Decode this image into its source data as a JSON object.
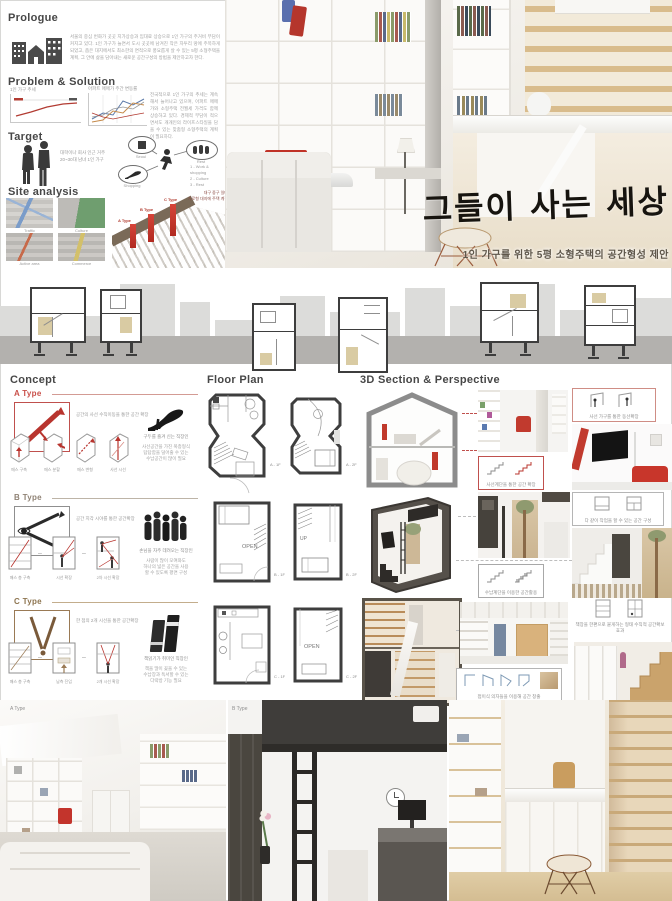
{
  "poster": {
    "prologue": {
      "title": "Prologue",
      "body": "서울의 중심 번화가 곳곳 지가상승과 임대료 상승으로 1인 가구의 주거비 부담이 커지고 있다. 1인 가구가 늘면서 도시 곳곳에 남겨진 작은 자투리 땅에 주목하게 되었고, 좁은 대지에서도 최소한의 면적으로 풍요롭게 살 수 있는 5평 소형주택을 계획, 그 안에 삶을 담아내는 새로운 공간구성의 방법을 제안하고자 한다."
    },
    "problem": {
      "title": "Problem & Solution",
      "chart1_title": "1인 가구 추세",
      "chart2_title": "아파트 매매가 주간 변동률",
      "body": "전국적으로 1인 가구의 추세는 계속해서 늘어나고 있으며, 아파트 매매가와 소형주택 전월세 가격도 함께 상승하고 있다. 경제적 부담이 적으면서도 개개인의 라이프스타일을 담을 수 있는 맞춤형 소형주택의 계획이 필요하다."
    },
    "target": {
      "title": "Target",
      "desc": "대학이나 회사 인근 거주\n20~30대 남녀 1인 가구",
      "node_seoul": "Seoul",
      "node_rest": "Rest",
      "node_shopping": "Shopping",
      "list": "1 - Work & shopping\n2 - Culture\n3 - Rest"
    },
    "site": {
      "title": "Site analysis",
      "map1": "Traffic",
      "map2": "Culture",
      "map3": "Active area",
      "map4": "Commerce",
      "note": "대구 중구 일대\n가로형 대지에 주택 계획",
      "bar_a": "A Type",
      "bar_b": "B Type",
      "bar_c": "C Type"
    },
    "hero": {
      "title": "그들이 사는 세상",
      "subtitle": "1인 가구를 위한 5평 소형주택의 공간형성 제안"
    },
    "columns": {
      "concept": "Concept",
      "floor_plan": "Floor Plan",
      "section": "3D Section & Perspective"
    },
    "type_a": {
      "label": "A Type",
      "concept_caption": "공간의 사선 수직이동을 통한 공간 확장",
      "step1": "매스 구축",
      "step2": "매스 분할",
      "step3": "매스 변형",
      "step4": "사선 시선",
      "persona": "구두를 즐겨 신는 직장인",
      "persona_desc": "사선공간을 가진 복층형식\n답답함을 덜어줄 수 있는\n수납공간이 많이 필요",
      "plan1": "A - 1F",
      "plan2": "A - 2F",
      "callout_top": "사선 가구를 통한 동선확장",
      "callout_bottom": "사선계단을 통한 공간 확장"
    },
    "type_b": {
      "label": "B Type",
      "concept_caption": "공간 지각 시야를 통한 공간확장",
      "step1": "매스 층 구축",
      "step2": "시선 확장",
      "step3": "2차 시선 확장",
      "persona": "손님을 자주 데려오는 직장인",
      "persona_desc": "사람이 많이 모여와도\n하나의 넓은 공간을 사용\n할 수 있도록 평면 구성",
      "plan1": "B - 1F",
      "plan2": "B - 2F",
      "plan1_open": "OPEN",
      "plan2_up": "UP",
      "callout_top": "다 같이 작업을 할 수 있는 공간 구성",
      "callout_bottom": "수납계단을 이용한 공간활용"
    },
    "type_c": {
      "label": "C Type",
      "concept_caption": "한 점의 2개 시선을 통한 공간확장",
      "step1": "매스 층 구축",
      "step2": "남측 진입",
      "step3": "2개 시선 확장",
      "persona": "책읽기가 취미인 직장인",
      "persona_desc": "책을 많이 꽂을 수 있는\n수납장과 독서할 수 있는\n다락방 기능 필요",
      "plan1": "C - 1F",
      "plan2": "C - 2F",
      "plan2_open": "OPEN",
      "callout_top": "책장을 한편으로 붙게하는 형태 수직적 공간확보 효과",
      "callout_bottom": "접이식 의자들을 이용해 공간 창출"
    },
    "bottom": {
      "a": "A Type",
      "b": "B Type",
      "c": "C Type"
    }
  }
}
